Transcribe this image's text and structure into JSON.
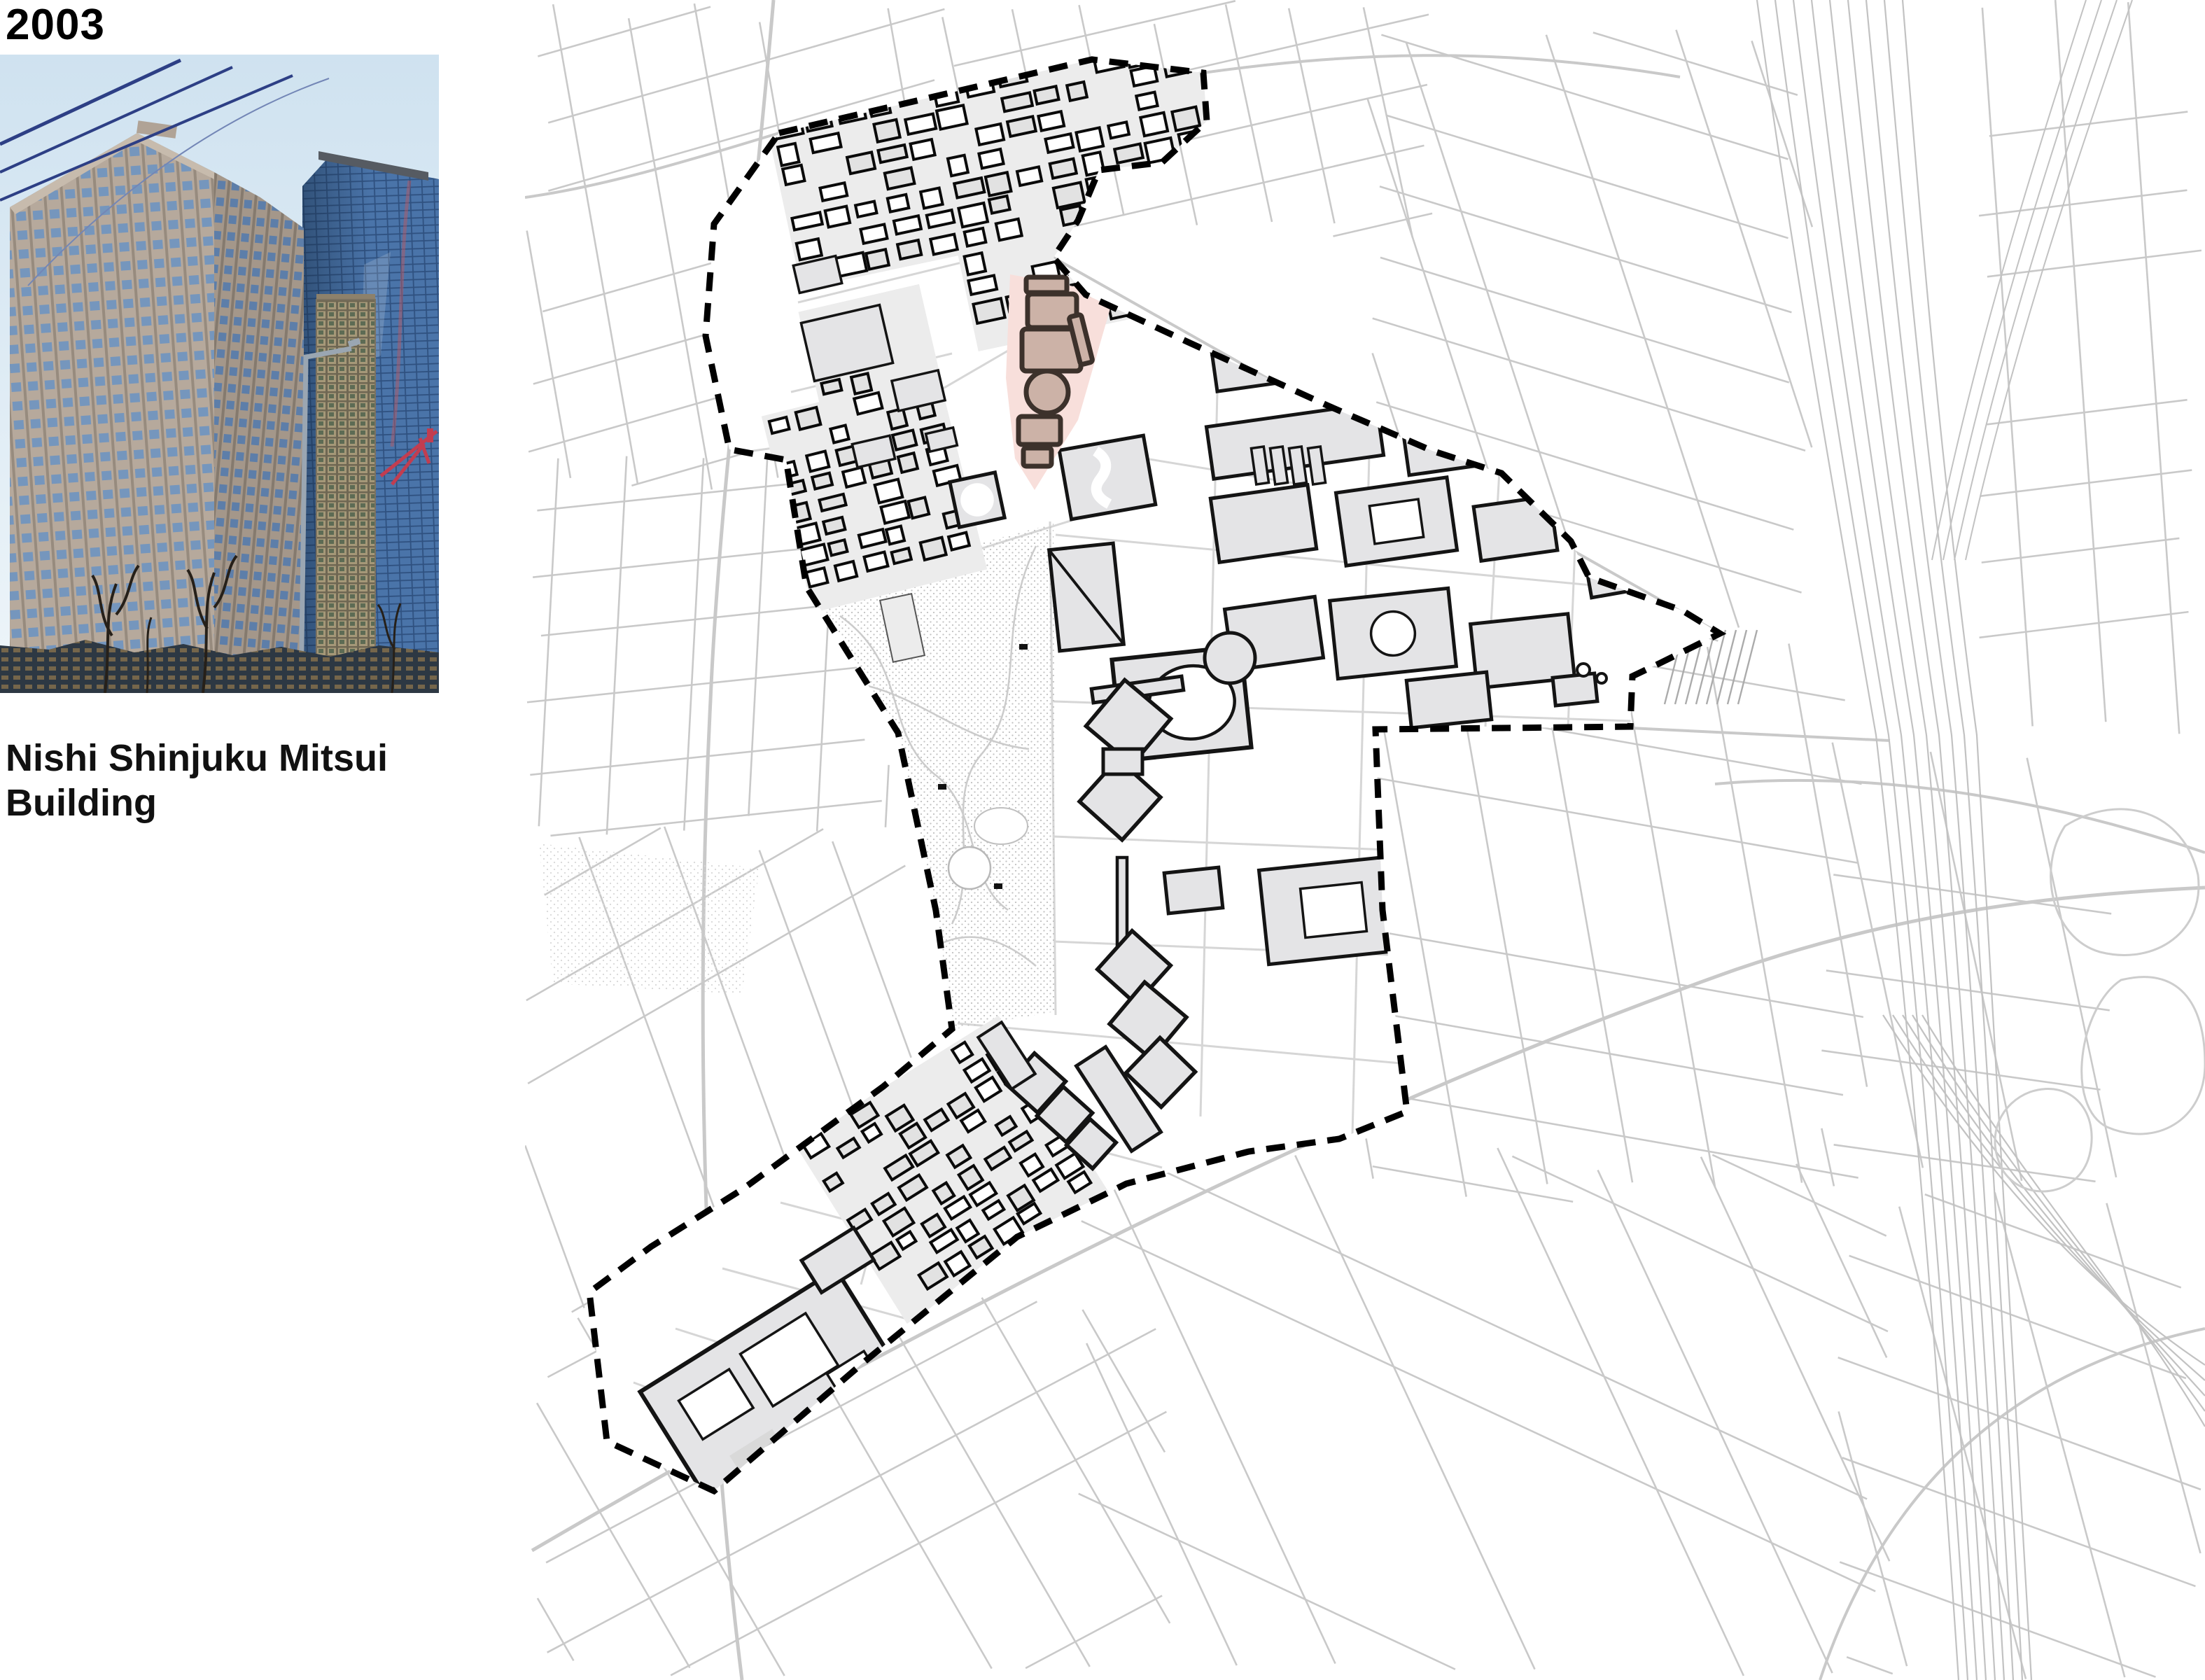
{
  "panel": {
    "year_label": "2003",
    "caption": "Nishi Shinjuku Mitsui Building"
  },
  "map": {
    "highlighted_building": "Nishi Shinjuku Mitsui Building",
    "boundary_style": "dashed",
    "colors": {
      "street": "#c9c9c9",
      "street_light": "#d6d6d6",
      "railway": "#c2c2c2",
      "building_fill": "#e4e4e6",
      "building_outline": "#141414",
      "block_tint": "#ececec",
      "park_dot": "#c3c3c3",
      "highlight_parcel": "#f8dfdb",
      "highlight_building_fill": "#ccb2a7",
      "highlight_building_outline": "#3c312b",
      "boundary": "#000000",
      "background": "#ffffff"
    }
  },
  "photo": {
    "subject": "Nishi Shinjuku Mitsui Building",
    "colors": {
      "sky_top": "#cfe2f0",
      "sky_bottom": "#eef5f9",
      "stone_tower": "#b6a99c",
      "glass_tower": "#4a74a9",
      "tan_tower": "#a59878",
      "crane": "#c23d50"
    }
  }
}
